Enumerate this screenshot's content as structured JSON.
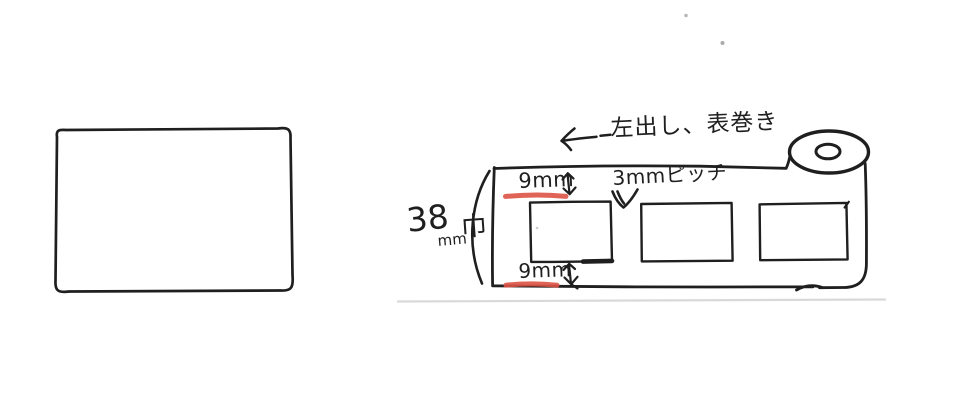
{
  "colors": {
    "ink": "#1f1f1f",
    "red_marker": "#dc5244",
    "faint_scan_line": "#d9d9d9"
  },
  "icons": {
    "left_arrow": "←",
    "updown_arrow": "↕",
    "down_arrow": "∨"
  },
  "left_sketch": {
    "content": ""
  },
  "roll_diagram": {
    "winding_note": "左出し、表巻き",
    "top_margin": "9mm",
    "bottom_margin": "9mm",
    "pitch": "3mmピッチ",
    "width": {
      "value": "38",
      "unit": "mm",
      "suffix": "巾"
    },
    "label_count": 3
  }
}
